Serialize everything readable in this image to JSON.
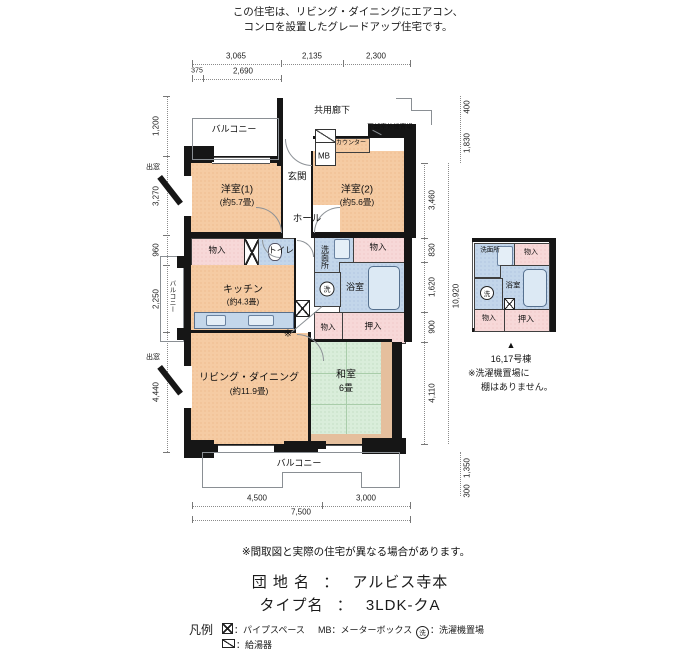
{
  "note_top": {
    "line1": "この住宅は、リビング・ダイニングにエアコン、",
    "line2": "コンロを設置したグレードアップ住宅です。"
  },
  "plan": {
    "labels": {
      "balcony_top": "バルコニー",
      "corridor": "共用廊下",
      "outdoor_unit": "下部室外機置場",
      "counter": "カウンター",
      "mb": "MB",
      "entrance": "玄関",
      "western1": "洋室(1)",
      "western1_size": "(約5.7畳)",
      "western2": "洋室(2)",
      "western2_size": "(約5.6畳)",
      "hall": "ホール",
      "bay_window_top": "出窓",
      "bay_window_bottom": "出窓",
      "storage_a": "物入",
      "toilet": "トイレ",
      "kitchen": "キッチン",
      "kitchen_size": "(約4.3畳)",
      "washroom": "洗面所",
      "laundry": "洗",
      "storage_b": "物入",
      "bath": "浴室",
      "storage_c": "物入",
      "closet": "押入",
      "balcony_left": "バルコニー",
      "living": "リビング・ダイニング",
      "living_size": "(約11.9畳)",
      "japanese": "和室",
      "japanese_size": "6畳",
      "asterisk": "※",
      "balcony_bottom": "バルコニー"
    },
    "dims": {
      "t1": "3,065",
      "t2": "2,135",
      "t3": "2,300",
      "t4": "375",
      "t5": "2,690",
      "l1": "1,200",
      "l2": "3,270",
      "l3": "960",
      "l4": "2,250",
      "l5": "4,440",
      "r1": "400",
      "r2": "1,830",
      "r3": "3,460",
      "r4": "830",
      "r5": "1,620",
      "r6": "900",
      "r7": "4,110",
      "r8": "1,350",
      "r9": "300",
      "r_total": "10,920",
      "b1": "4,500",
      "b2": "3,000",
      "b_total": "7,500"
    }
  },
  "sub_plan": {
    "washroom": "洗面所",
    "storage_top": "物入",
    "bath": "浴室",
    "laundry": "洗",
    "storage_bottom": "物入",
    "closet": "押入",
    "pointer": "▲",
    "caption": "16,17号棟",
    "note1": "※洗濯機置場に",
    "note2": "棚はありません。"
  },
  "footer": {
    "disclaimer": "※間取図と実際の住宅が異なる場合があります。",
    "estate_label": "団 地 名",
    "estate_sep": "：",
    "estate_value": "アルビス寺本",
    "type_label": "タイプ名",
    "type_sep": "：",
    "type_value": "3LDK-クA",
    "legend_title": "凡例",
    "legend_pipe": "：パイプスペース",
    "legend_mb_key": "MB",
    "legend_mb": "：メーターボックス",
    "legend_wash_key": "洗",
    "legend_wash": "：洗濯機置場",
    "legend_heater": "：給湯器"
  },
  "colors": {
    "room_peach": "#f5cba3",
    "closet_pink": "#f7d8d8",
    "wet_blue": "#c3d6ea",
    "tatami_green": "#d9edda",
    "wall": "#161616"
  }
}
